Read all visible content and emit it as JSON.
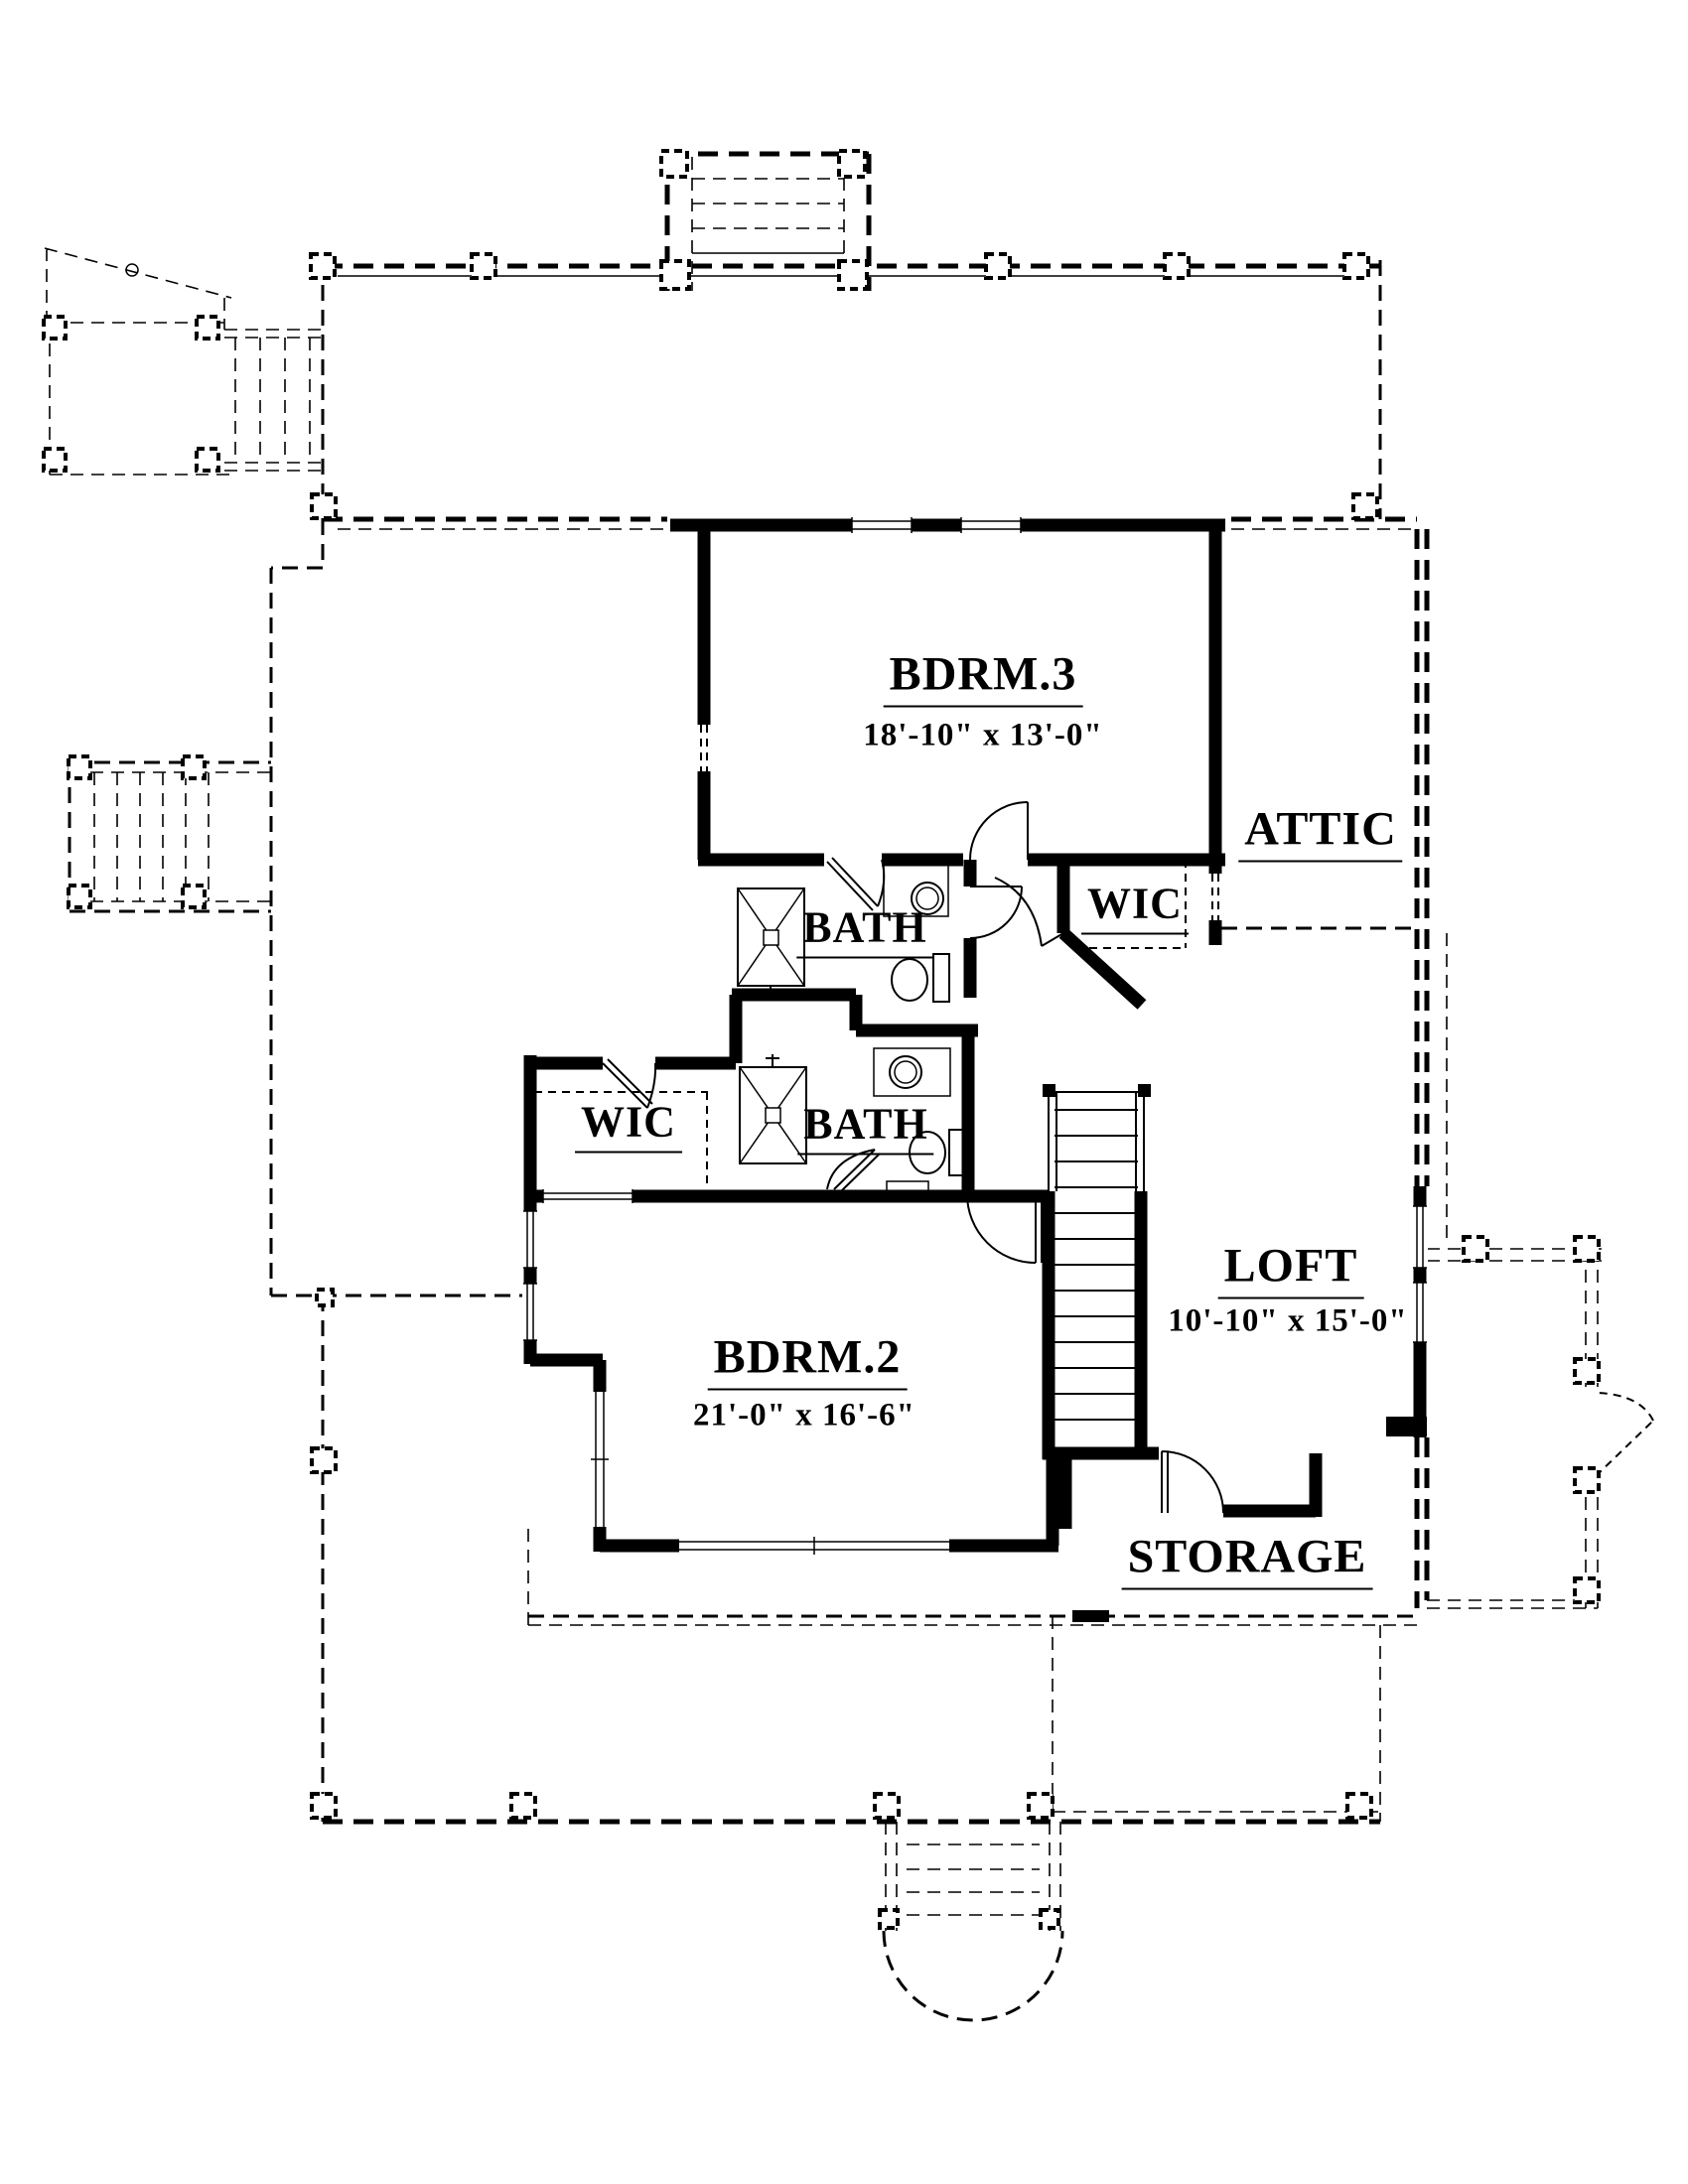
{
  "plan": {
    "bg_color": "#ffffff",
    "line_color": "#000000",
    "rooms": [
      {
        "id": "bdrm3",
        "label": "BDRM.3",
        "dims": "18'-10\" x 13'-0\""
      },
      {
        "id": "attic",
        "label": "ATTIC",
        "dims": ""
      },
      {
        "id": "wic-upper",
        "label": "WIC",
        "dims": ""
      },
      {
        "id": "bath-upper",
        "label": "BATH",
        "dims": ""
      },
      {
        "id": "wic-lower",
        "label": "WIC",
        "dims": ""
      },
      {
        "id": "bath-lower",
        "label": "BATH",
        "dims": ""
      },
      {
        "id": "loft",
        "label": "LOFT",
        "dims": "10'-10\" x 15'-0\""
      },
      {
        "id": "bdrm2",
        "label": "BDRM.2",
        "dims": "21'-0\" x 16'-6\""
      },
      {
        "id": "storage",
        "label": "STORAGE",
        "dims": ""
      }
    ]
  }
}
